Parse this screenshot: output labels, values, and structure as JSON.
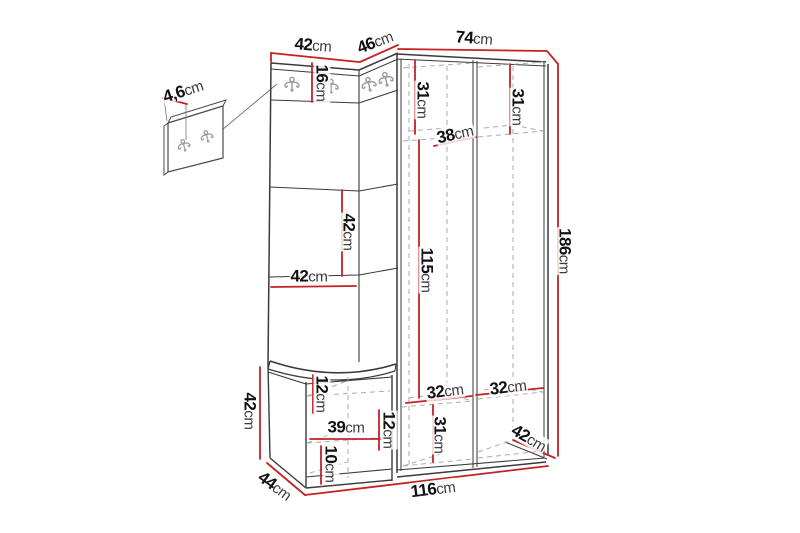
{
  "title": "Hallway furniture set — dimensional line drawing",
  "figure_type": "furniture-dimension-diagram",
  "unit": "cm",
  "colors": {
    "background": "#ffffff",
    "dimension_line": "#c42323",
    "outline": "#3a3a3a",
    "hidden_line": "#ababab",
    "hook_icon": "#9aa0a4"
  },
  "icons": {
    "coat_hook": "double-coat-hook"
  },
  "dimensions": [
    {
      "id": "top-left-width",
      "value": "42",
      "unit": "cm"
    },
    {
      "id": "top-corner-width",
      "value": "46",
      "unit": "cm"
    },
    {
      "id": "top-right-width",
      "value": "74",
      "unit": "cm"
    },
    {
      "id": "hook-panel-thickness",
      "value": "4,6",
      "unit": "cm"
    },
    {
      "id": "hook-rail-height",
      "value": "16",
      "unit": "cm"
    },
    {
      "id": "left-column-top",
      "value": "31",
      "unit": "cm"
    },
    {
      "id": "right-column-top",
      "value": "31",
      "unit": "cm"
    },
    {
      "id": "shelf-depth",
      "value": "38",
      "unit": "cm"
    },
    {
      "id": "panel-segment-height",
      "value": "42",
      "unit": "cm"
    },
    {
      "id": "panel-width",
      "value": "42",
      "unit": "cm"
    },
    {
      "id": "hanging-space-height",
      "value": "115",
      "unit": "cm"
    },
    {
      "id": "total-height",
      "value": "186",
      "unit": "cm"
    },
    {
      "id": "bench-height",
      "value": "42",
      "unit": "cm"
    },
    {
      "id": "seat-to-shelf",
      "value": "12",
      "unit": "cm"
    },
    {
      "id": "bench-inner-width",
      "value": "39",
      "unit": "cm"
    },
    {
      "id": "bench-shelf-gap",
      "value": "12",
      "unit": "cm"
    },
    {
      "id": "bench-bottom-gap",
      "value": "10",
      "unit": "cm"
    },
    {
      "id": "bench-depth",
      "value": "44",
      "unit": "cm"
    },
    {
      "id": "bottom-shelf-left",
      "value": "32",
      "unit": "cm"
    },
    {
      "id": "bottom-shelf-right",
      "value": "32",
      "unit": "cm"
    },
    {
      "id": "bottom-compartment",
      "value": "31",
      "unit": "cm"
    },
    {
      "id": "wardrobe-depth",
      "value": "42",
      "unit": "cm"
    },
    {
      "id": "total-width",
      "value": "116",
      "unit": "cm"
    }
  ]
}
